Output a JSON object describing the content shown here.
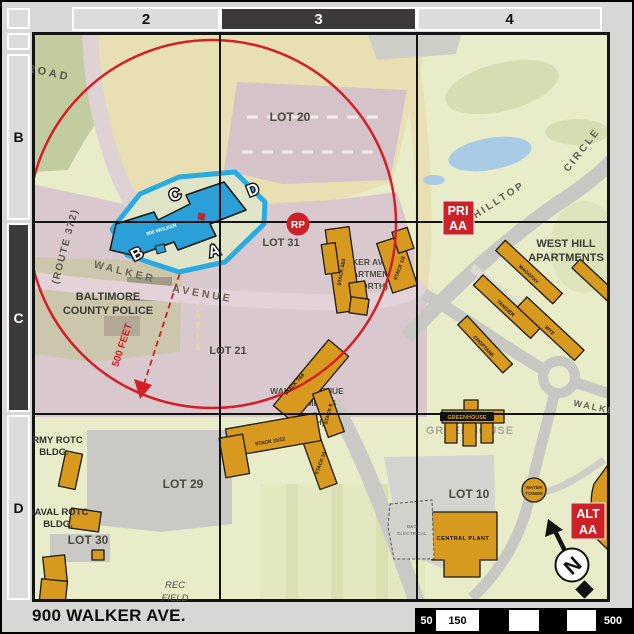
{
  "grid": {
    "columns": [
      "2",
      "3",
      "4"
    ],
    "rows": [
      "B",
      "C",
      "D"
    ],
    "highlighted_column": "3",
    "highlighted_row": "C"
  },
  "footer": {
    "address": "900 WALKER AVE.",
    "scale": [
      "50",
      "150",
      "500"
    ]
  },
  "markers": {
    "rp": "RP",
    "pri": {
      "line1": "PRI",
      "line2": "AA"
    },
    "alt": {
      "line1": "ALT",
      "line2": "AA"
    },
    "north": "N",
    "radius_label": "500 FEET"
  },
  "highlight": {
    "building": "900 WALKER",
    "corners": {
      "a": "A",
      "b": "B",
      "c": "C",
      "d": "D"
    }
  },
  "roads": {
    "road": "ROAD",
    "route": "(ROUTE 372)",
    "walker": "WALKER",
    "avenue": "AVENUE",
    "hilltop": "HILLTOP",
    "circle": "CIRCLE",
    "walker_east": "WALKER"
  },
  "lots": {
    "lot20": "LOT 20",
    "lot31": "LOT 31",
    "lot21": "LOT 21",
    "lot29": "LOT 29",
    "lot30": "LOT 30",
    "lot10": "LOT 10"
  },
  "places": {
    "police": [
      "BALTIMORE",
      "COUNTY POLICE"
    ],
    "north_apts": [
      "WALKER AVENUE",
      "APARTMENTS",
      "(NORTH)"
    ],
    "south_apts": [
      "WALKER AVENUE",
      "APARTMENTS",
      "(SOUTH)"
    ],
    "west_hill": [
      "WEST HILL",
      "APARTMENTS"
    ],
    "army": [
      "ARMY ROTC",
      "BLDG."
    ],
    "naval": [
      "NAVAL ROTC",
      "BLDG."
    ],
    "rec": [
      "REC",
      "FIELD"
    ],
    "greenhouse": "GREENHOUSE",
    "greenhouse_banner": "GREENHOUSE",
    "central_plant": "CENTRAL PLANT",
    "water_tower": [
      "WATER",
      "TOWER"
    ],
    "electrical": [
      "B&G",
      "ELECTRICAL"
    ],
    "stacks": {
      "s35": "STACK 3&5",
      "s12": "STACK 1/2",
      "s79": "STACK 7&9",
      "s8": "STACK 8",
      "s10": "STACK 10",
      "s1112": "STACK 11/12"
    },
    "west_hill_bldgs": {
      "magothy": "MAGOTHY",
      "tangier": "TANGIER",
      "choptank": "CHOPTANK",
      "wye": "WYE"
    }
  },
  "colors": {
    "accent_red": "#cc2127",
    "highlight_blue": "#29abe2",
    "building_orange": "#d79a1f"
  }
}
